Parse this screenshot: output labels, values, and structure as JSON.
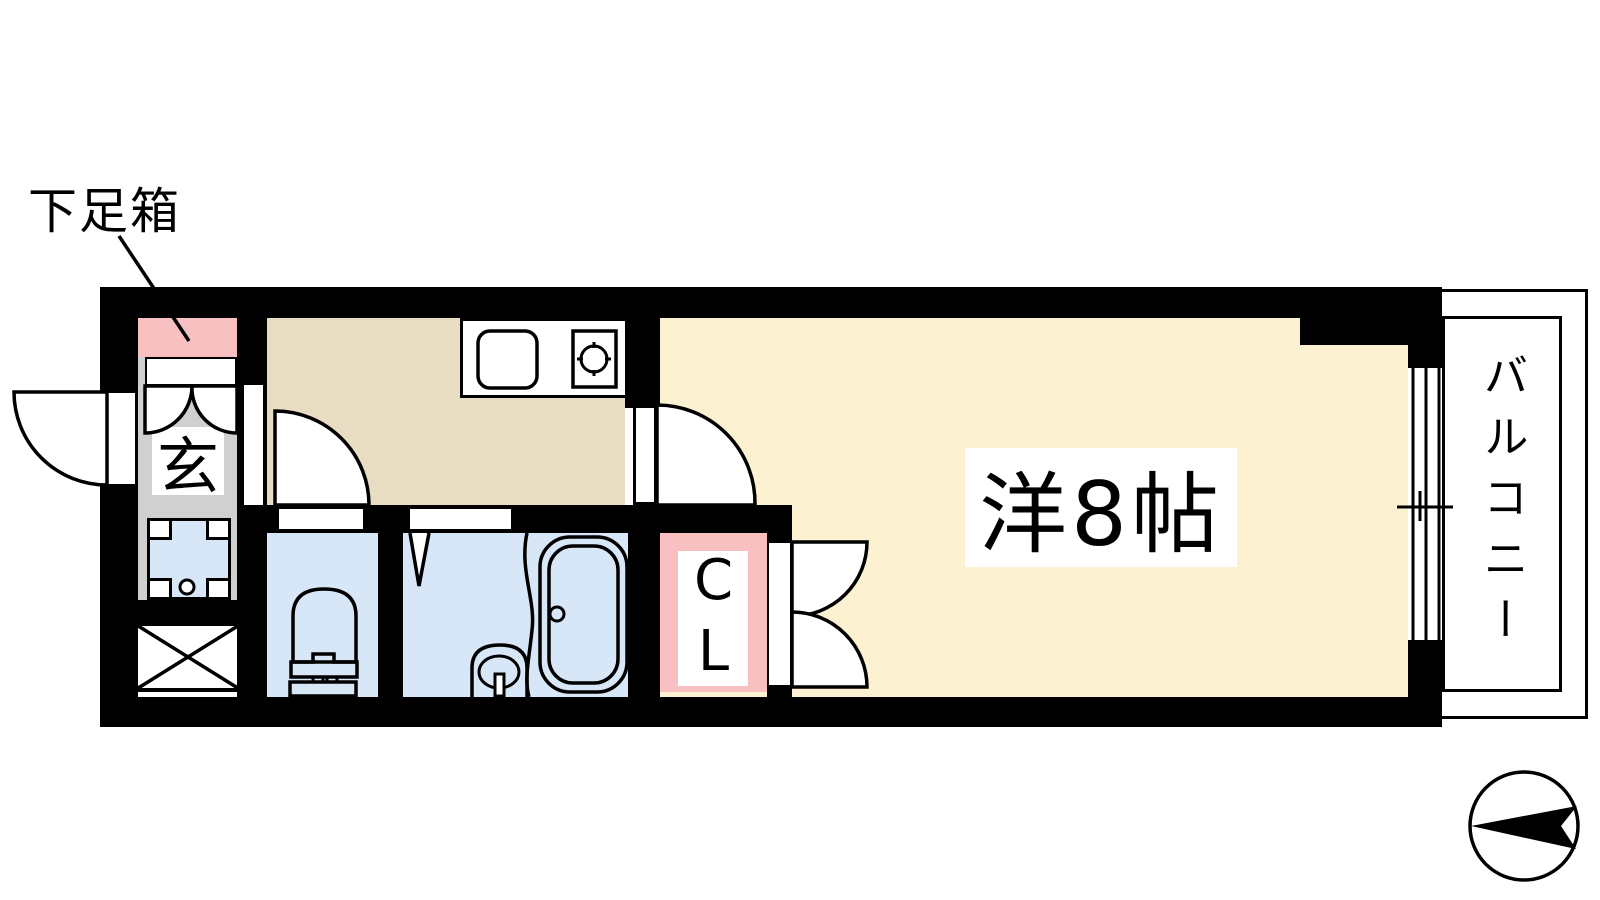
{
  "plan": {
    "labels": {
      "shoe_box": "下足箱",
      "entrance": "玄",
      "closet": "CL",
      "main_room": "洋8帖",
      "balcony": "バルコニー"
    },
    "colors": {
      "wall": "#000000",
      "line": "#000000",
      "entrance-floor": "#d0d0d0",
      "pink": "#f8c0c0",
      "kitchen": "#e8dcc2",
      "room": "#fcf2d2",
      "water": "#d8e7f8",
      "white": "#ffffff"
    }
  }
}
